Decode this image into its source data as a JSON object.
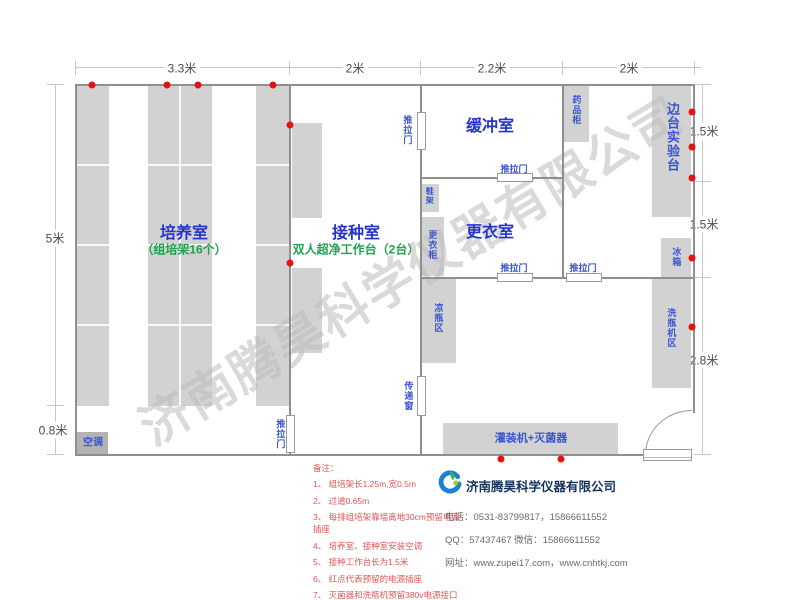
{
  "watermark": "济南腾昊科学仪器有限公司",
  "dims": {
    "top1": "3.3米",
    "top2": "2米",
    "top3": "2.2米",
    "top4": "2米",
    "left1": "5米",
    "left2": "0.8米",
    "right1": "1.5米",
    "right2": "1.5米",
    "right3": "2.8米"
  },
  "rooms": {
    "culture_name": "培养室",
    "culture_sub": "（组培架16个）",
    "inoculation_name": "接种室",
    "inoculation_sub": "双人超净工作台（2台）",
    "buffer_name": "缓冲室",
    "changing_name": "更衣室",
    "side_bench": "边台实验台"
  },
  "fixtures": {
    "medicine_cabinet": "药品柜",
    "fridge": "冰箱",
    "washer_area": "洗瓶机区",
    "cool_bottle": "凉瓶区",
    "shoe_rack": "鞋架",
    "locker": "更衣柜",
    "air_conditioner": "空调",
    "filler_sterilizer": "灌装机+灭菌器"
  },
  "openings": {
    "sliding_door": "推拉门",
    "pass_window": "传递窗"
  },
  "notes": {
    "header": "备注：",
    "items": [
      "1、 组培架长1.25m,宽0.5m",
      "2、 过道0.65m",
      "3、 每排组培架靠墙离地30cm预留电源插座",
      "4、 培养室、接种室安装空调",
      "5、 接种工作台长为1.5米",
      "6、 红点代表预留的电源插座",
      "7、 灭菌器和洗瓶机预留380v电源接口"
    ]
  },
  "company": {
    "name": "济南腾昊科学仪器有限公司",
    "phone": "电话：0531-83799817，15866611552",
    "qq_wechat": "QQ：57437467    微信：15866611552",
    "website": "网址：www.zupei17.com，www.cnhtkj.com"
  },
  "colors": {
    "accent_blue": "#2535c8",
    "accent_green": "#1fa34f",
    "outlet_red": "#e81010",
    "furniture_gray": "#d2d2d2"
  }
}
